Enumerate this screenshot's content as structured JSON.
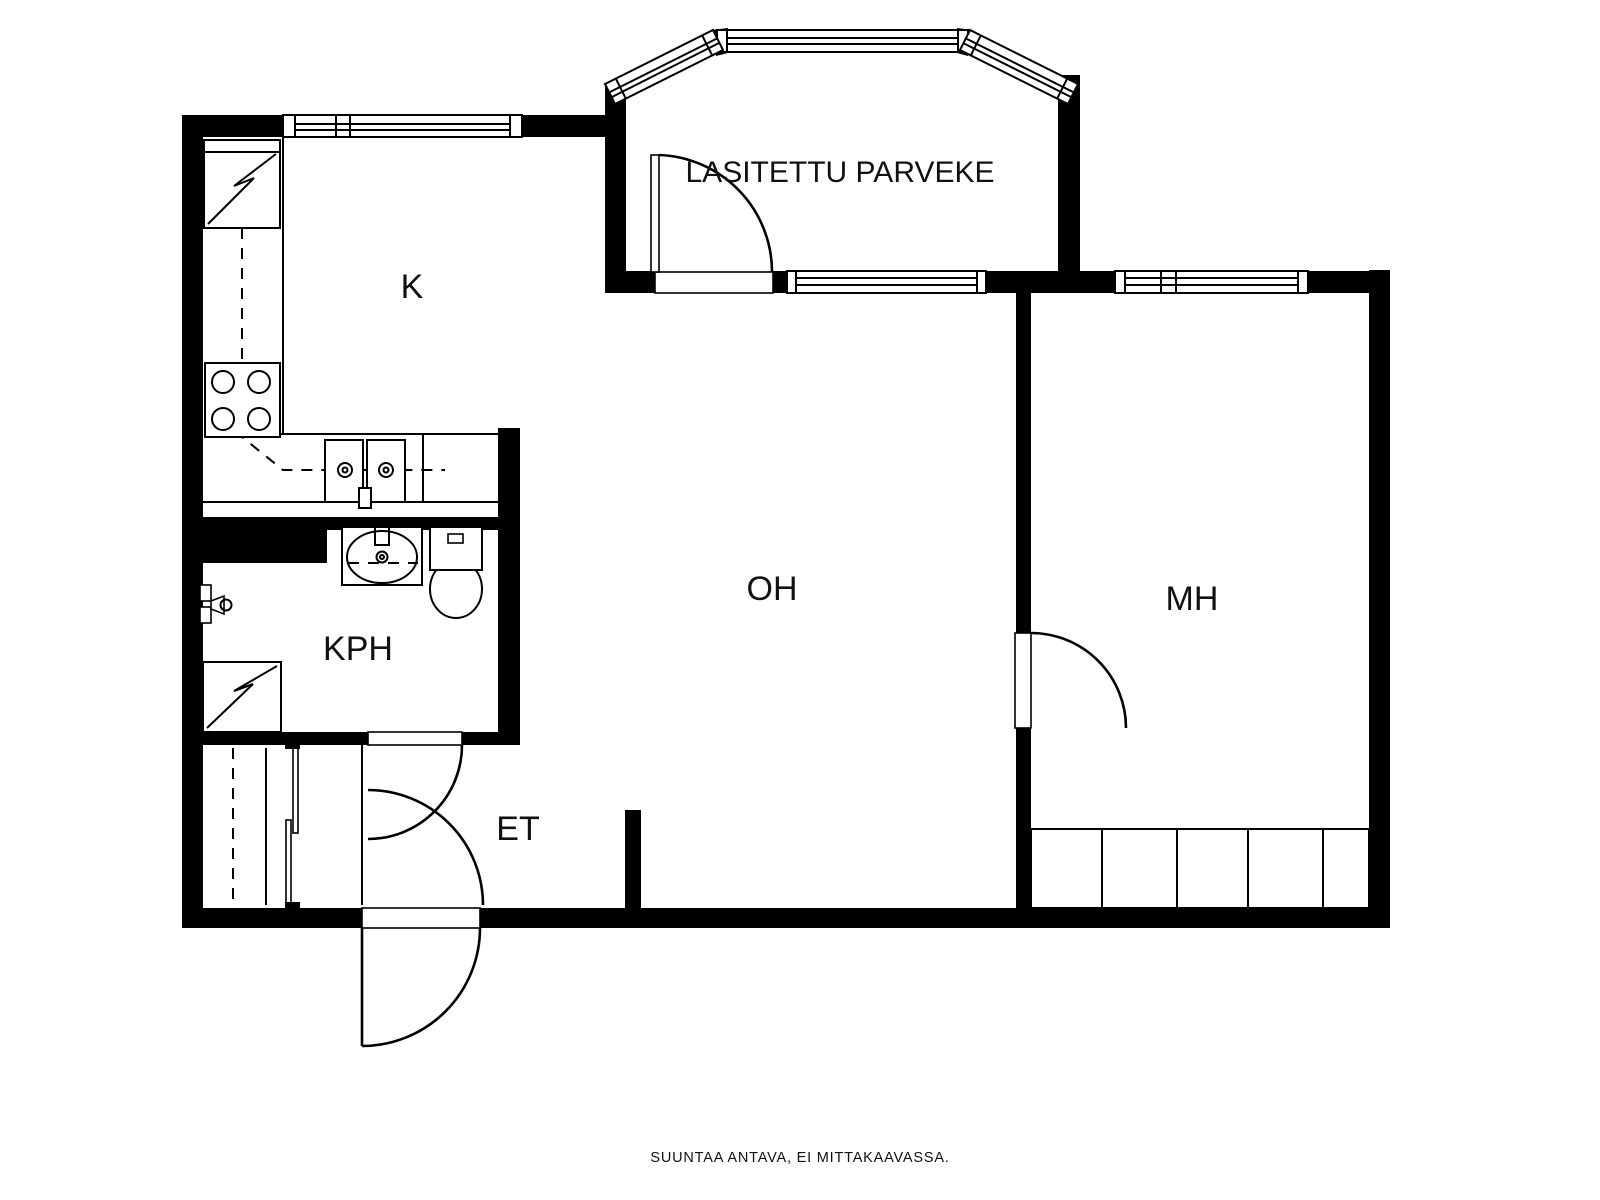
{
  "plan": {
    "type": "apartment-floor-plan",
    "rooms": {
      "balcony": "LASITETTU PARVEKE",
      "kitchen": "K",
      "living_room": "OH",
      "bedroom": "MH",
      "bathroom": "KPH",
      "entry": "ET"
    },
    "caption": "SUUNTAA ANTAVA, EI MITTAKAAVASSA.",
    "colors": {
      "wall": "#000000",
      "background": "#ffffff",
      "text": "#111111"
    },
    "fixtures": [
      "refrigerator",
      "stove-4-burners",
      "kitchen-double-sink",
      "washbasin",
      "toilet",
      "washing-machine",
      "shower-tap",
      "sliding-door-closet",
      "wardrobe-5-units"
    ]
  }
}
